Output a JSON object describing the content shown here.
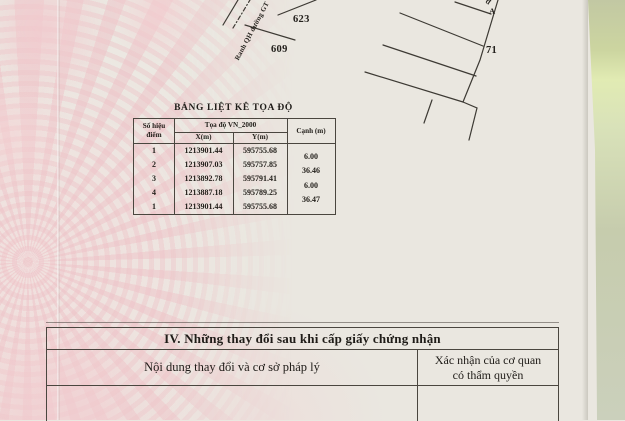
{
  "map": {
    "label_623": "623",
    "label_609": "609",
    "label_71": "71",
    "label_point_a": "A",
    "label_edge_fragment": "đ",
    "boundary_label": "Ranh QH đường GT"
  },
  "coordinate_table": {
    "title": "BẢNG LIỆT KÊ TỌA ĐỘ",
    "header": {
      "point_no_line1": "Số hiệu",
      "point_no_line2": "điểm",
      "coord_system": "Tọa độ VN_2000",
      "x": "X(m)",
      "y": "Y(m)",
      "edge": "Cạnh (m)"
    },
    "rows": [
      {
        "point": "1",
        "x": "1213901.44",
        "y": "595755.68"
      },
      {
        "point": "2",
        "x": "1213907.03",
        "y": "595757.85"
      },
      {
        "point": "3",
        "x": "1213892.78",
        "y": "595791.41"
      },
      {
        "point": "4",
        "x": "1213887.18",
        "y": "595789.25"
      },
      {
        "point": "1",
        "x": "1213901.44",
        "y": "595755.68"
      }
    ],
    "edges": [
      "6.00",
      "36.46",
      "6.00",
      "36.47"
    ]
  },
  "section_iv": {
    "title": "IV. Những thay đổi sau khi cấp giấy chứng nhận",
    "left_header": "Nội dung thay đổi và cơ sở pháp lý",
    "right_header_line1": "Xác nhận của cơ quan",
    "right_header_line2": "có thẩm quyền"
  },
  "colors": {
    "paper": "#eae7e0",
    "pattern_pink": "#f2d6d8",
    "tabletop_green": "#cdd5a3",
    "line": "#4a463f",
    "text": "#24211c"
  }
}
